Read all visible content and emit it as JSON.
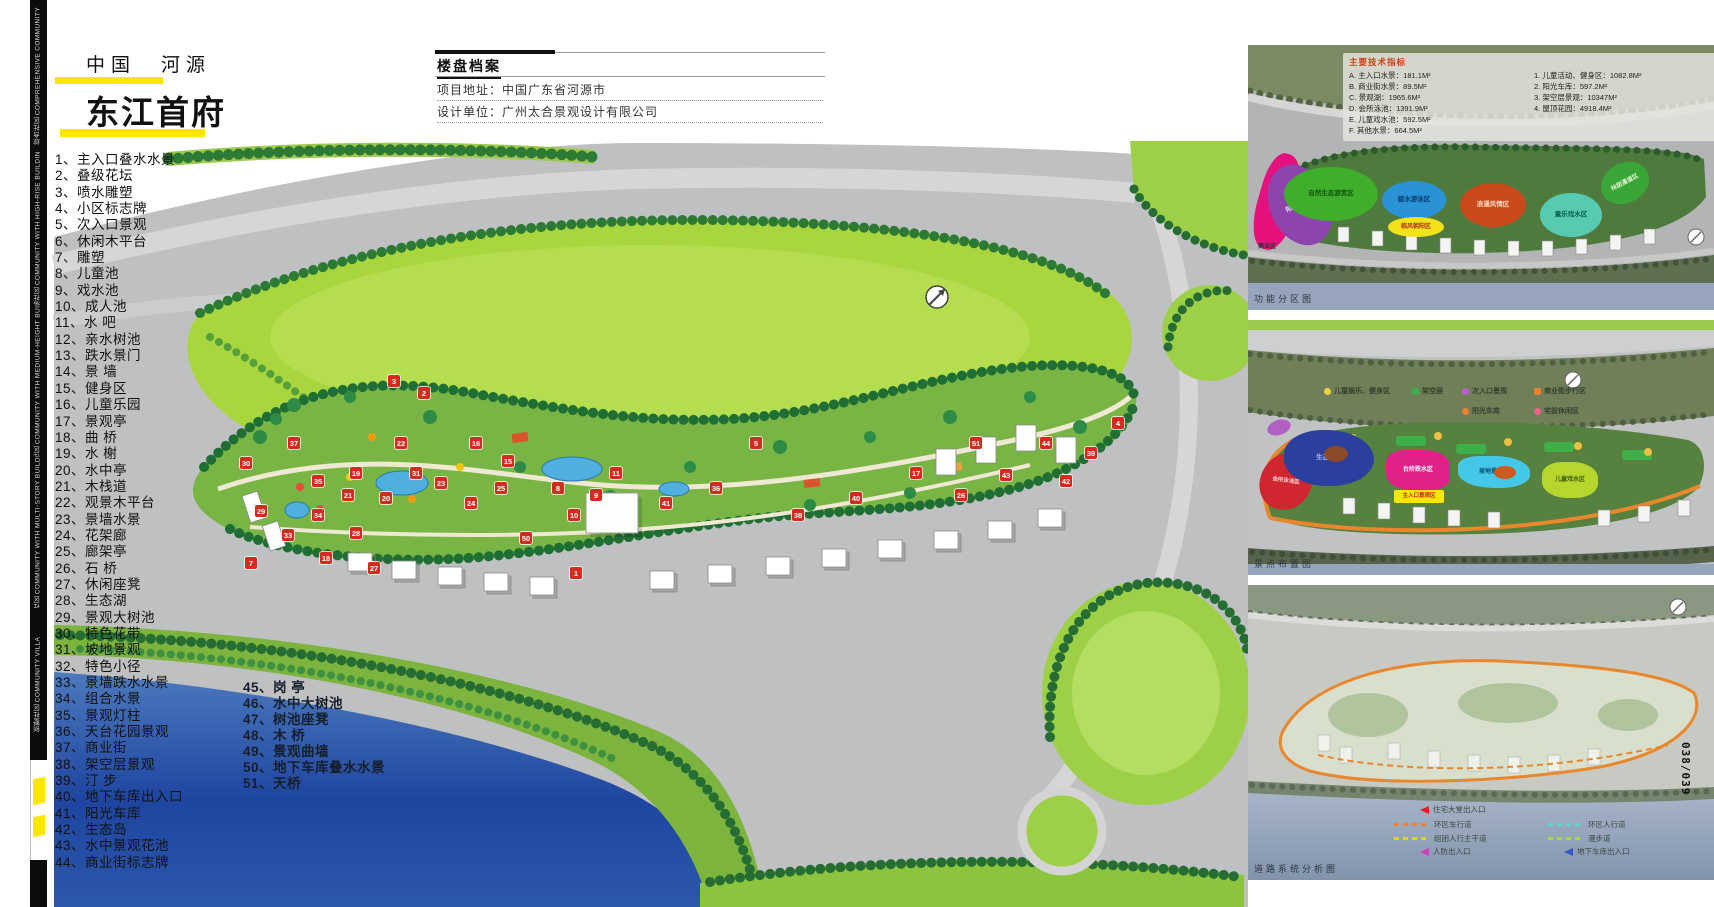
{
  "page": {
    "page_number": "038/039",
    "accent_color": "#ffe600"
  },
  "edge_strip": {
    "segments": [
      "综合社区 COMPREHENSIVE COMMUNITY",
      "高层社区 COMMUNITY WITH HIGH-RISE BUILDINGS",
      "小高层社区 COMMUNITY WITH MEDIUM-HEIGHT BUILDINGS",
      "多层社区 COMMUNITY WITH MULTI-STORY BUILDINGS",
      "别墅社区 COMMUNITY VILLA"
    ]
  },
  "header": {
    "location": "中国　河源",
    "project_name": "东江首府"
  },
  "property_file": {
    "title": "楼盘档案",
    "rows": [
      {
        "label": "项目地址：",
        "value": "中国广东省河源市"
      },
      {
        "label": "设计单位：",
        "value": "广州太合景观设计有限公司"
      }
    ]
  },
  "legend_col1": [
    "1、主入口叠水水景",
    "2、叠级花坛",
    "3、喷水雕塑",
    "4、小区标志牌",
    "5、次入口景观",
    "6、休闲木平台",
    "7、雕塑",
    "8、儿童池",
    "9、戏水池",
    "10、成人池",
    "11、水 吧",
    "12、亲水树池",
    "13、跌水景门",
    "14、景 墙",
    "15、健身区",
    "16、儿童乐园",
    "17、景观亭",
    "18、曲 桥",
    "19、水 榭",
    "20、水中亭",
    "21、木栈道",
    "22、观景木平台",
    "23、景墙水景",
    "24、花架廊",
    "25、廊架亭",
    "26、石 桥",
    "27、休闲座凳",
    "28、生态湖",
    "29、景观大树池",
    "30、特色花带",
    "31、坡地景观",
    "32、特色小径",
    "33、景墙跌水水景",
    "34、组合水景",
    "35、景观灯柱",
    "36、天台花园景观",
    "37、商业街",
    "38、架空层景观",
    "39、汀 步",
    "40、地下车库出入口",
    "41、阳光车库",
    "42、生态岛",
    "43、水中景观花池",
    "44、商业街标志牌"
  ],
  "legend_col2": [
    "45、岗 亭",
    "46、水中大树池",
    "47、树池座凳",
    "48、木 桥",
    "49、景观曲墙",
    "50、地下车库叠水水景",
    "51、天桥"
  ],
  "tech_indicators": {
    "title": "主要技术指标",
    "col_a": [
      "A. 主入口水景：181.1M²",
      "B. 商业街水景：89.5M²",
      "C. 景观湖：1965.6M²",
      "D. 会所泳池：1391.9M²",
      "E. 儿童戏水池：592.5M²",
      "F. 其他水景：664.5M²"
    ],
    "col_b": [
      "1. 儿童活动、健身区：1082.8M²",
      "2. 阳光车库：597.2M²",
      "3. 架空层景观：10347M²",
      "4. 屋顶花园：4918.4M²"
    ]
  },
  "minimap1": {
    "caption": "功能分区图",
    "zones": [
      {
        "label": "",
        "x": 10,
        "y": 108,
        "w": 40,
        "h": 98,
        "bg": "#e5127d",
        "rot": 16,
        "rad": "40% 60% 50% 50%"
      },
      {
        "label": "阳光静养区",
        "x": 22,
        "y": 118,
        "w": 60,
        "h": 84,
        "bg": "#8e44ad",
        "rot": -24,
        "tc": "#eadcf5",
        "fs": 6
      },
      {
        "label": "自然生态游赏区",
        "x": 36,
        "y": 122,
        "w": 94,
        "h": 54,
        "bg": "#3fae2a",
        "tc": "#15540e",
        "fs": 6.5
      },
      {
        "label": "碧水游泳区",
        "x": 134,
        "y": 136,
        "w": 64,
        "h": 38,
        "bg": "#2a93d5",
        "tc": "#083a6e",
        "fs": 6.5
      },
      {
        "label": "临风朝阳区",
        "x": 140,
        "y": 172,
        "w": 56,
        "h": 20,
        "bg": "#f3e11c",
        "tc": "#b03020",
        "fs": 6
      },
      {
        "label": "浪漫风情区",
        "x": 212,
        "y": 138,
        "w": 66,
        "h": 44,
        "bg": "#c8491a",
        "tc": "#ffd9c2",
        "fs": 6.5
      },
      {
        "label": "童乐戏水区",
        "x": 292,
        "y": 148,
        "w": 62,
        "h": 44,
        "bg": "#57cbb2",
        "tc": "#0a5c4a",
        "fs": 6.5
      },
      {
        "label": "林荫漫道区",
        "x": 352,
        "y": 118,
        "w": 50,
        "h": 40,
        "bg": "#39a637",
        "rot": -28,
        "tc": "#dff5c9",
        "fs": 6
      },
      {
        "label": "商业区",
        "x": 2,
        "y": 196,
        "w": 34,
        "h": 12,
        "bg": "transparent",
        "tc": "#2f2f2f",
        "fs": 6,
        "rad": "0"
      }
    ]
  },
  "minimap2": {
    "caption": "景点布置图",
    "zones": [
      {
        "label": "",
        "x": 19,
        "y": 100,
        "w": 24,
        "h": 15,
        "bg": "#b05fc4",
        "rot": -18
      },
      {
        "label": "会所泳池区",
        "x": 12,
        "y": 132,
        "w": 52,
        "h": 58,
        "bg": "#cf2630",
        "rot": 8,
        "tc": "#ffd7d7",
        "fs": 5.5,
        "rad": "60% 40% 55% 45%"
      },
      {
        "label": "生态湖区",
        "x": 36,
        "y": 110,
        "w": 90,
        "h": 56,
        "bg": "#2b3f9e",
        "tc": "#9db8f0",
        "fs": 6.5,
        "rad": "45% 55% 50% 50%"
      },
      {
        "label": "",
        "x": 76,
        "y": 126,
        "w": 24,
        "h": 16,
        "bg": "#8b4a2a"
      },
      {
        "label": "台阶跌水区",
        "x": 138,
        "y": 130,
        "w": 64,
        "h": 40,
        "bg": "#e0218a",
        "tc": "#ffffff",
        "fs": 6,
        "rad": "30% 40% 30% 40%"
      },
      {
        "label": "主入口景观区",
        "x": 146,
        "y": 170,
        "w": 50,
        "h": 13,
        "bg": "#ffe600",
        "tc": "#c02020",
        "fs": 5.5,
        "rad": "2px"
      },
      {
        "label": "坡地景观区",
        "x": 210,
        "y": 136,
        "w": 72,
        "h": 32,
        "bg": "#45c8e8",
        "tc": "#074f70",
        "fs": 6,
        "rad": "30% 50% 40% 50%"
      },
      {
        "label": "",
        "x": 246,
        "y": 146,
        "w": 22,
        "h": 13,
        "bg": "#cc5a1a"
      },
      {
        "label": "儿童戏水区",
        "x": 294,
        "y": 142,
        "w": 56,
        "h": 36,
        "bg": "#b6d62e",
        "tc": "#3f5e00",
        "fs": 6,
        "rad": "35% 45% 40% 45%"
      }
    ],
    "legend_dots": [
      {
        "x": 76,
        "y": 66,
        "color": "#f0d23c",
        "label": "儿童娱乐、健身区"
      },
      {
        "x": 214,
        "y": 66,
        "color": "#c05fd0",
        "label": "次入口景观"
      },
      {
        "x": 214,
        "y": 86,
        "color": "#f08030",
        "label": "阳光车库"
      },
      {
        "x": 286,
        "y": 86,
        "color": "#f06080",
        "label": "宅前休闲区"
      }
    ],
    "legend_squares": [
      {
        "x": 164,
        "y": 66,
        "color": "#3faf4a",
        "label": "架空层"
      },
      {
        "x": 286,
        "y": 66,
        "color": "#f08030",
        "label": "商业街步行区"
      }
    ]
  },
  "minimap3": {
    "caption": "道路系统分析图",
    "legend_arrows": [
      {
        "x": 168,
        "y": 219,
        "color": "#e02020",
        "label": "住宅大堂出入口"
      },
      {
        "x": 168,
        "y": 261,
        "color": "#d040c0",
        "label": "人防出入口"
      },
      {
        "x": 312,
        "y": 261,
        "color": "#3858c8",
        "label": "地下车库出入口"
      }
    ],
    "legend_dashes": [
      {
        "x": 146,
        "y": 234,
        "color": "#f08030",
        "label": "环区车行道"
      },
      {
        "x": 146,
        "y": 248,
        "color": "#e8d020",
        "label": "组团人行主干道"
      },
      {
        "x": 300,
        "y": 234,
        "color": "#58d8d0",
        "label": "环区人行道"
      },
      {
        "x": 300,
        "y": 248,
        "color": "#a8d840",
        "label": "漫步道"
      }
    ]
  },
  "main_plan": {
    "markers": [
      {
        "n": "30",
        "x": 190,
        "y": 320
      },
      {
        "n": "37",
        "x": 238,
        "y": 300
      },
      {
        "n": "35",
        "x": 262,
        "y": 338
      },
      {
        "n": "29",
        "x": 205,
        "y": 368
      },
      {
        "n": "33",
        "x": 232,
        "y": 392
      },
      {
        "n": "34",
        "x": 262,
        "y": 372
      },
      {
        "n": "21",
        "x": 292,
        "y": 352
      },
      {
        "n": "28",
        "x": 300,
        "y": 390
      },
      {
        "n": "7",
        "x": 195,
        "y": 420
      },
      {
        "n": "18",
        "x": 270,
        "y": 415
      },
      {
        "n": "27",
        "x": 318,
        "y": 425
      },
      {
        "n": "31",
        "x": 360,
        "y": 330
      },
      {
        "n": "19",
        "x": 300,
        "y": 330
      },
      {
        "n": "20",
        "x": 330,
        "y": 355
      },
      {
        "n": "22",
        "x": 345,
        "y": 300
      },
      {
        "n": "23",
        "x": 385,
        "y": 340
      },
      {
        "n": "24",
        "x": 415,
        "y": 360
      },
      {
        "n": "25",
        "x": 445,
        "y": 345
      },
      {
        "n": "3",
        "x": 338,
        "y": 238
      },
      {
        "n": "2",
        "x": 368,
        "y": 250
      },
      {
        "n": "16",
        "x": 420,
        "y": 300
      },
      {
        "n": "15",
        "x": 452,
        "y": 318
      },
      {
        "n": "8",
        "x": 502,
        "y": 345
      },
      {
        "n": "9",
        "x": 540,
        "y": 352
      },
      {
        "n": "10",
        "x": 518,
        "y": 372
      },
      {
        "n": "11",
        "x": 560,
        "y": 330
      },
      {
        "n": "1",
        "x": 520,
        "y": 430
      },
      {
        "n": "50",
        "x": 470,
        "y": 395
      },
      {
        "n": "41",
        "x": 610,
        "y": 360
      },
      {
        "n": "36",
        "x": 660,
        "y": 345
      },
      {
        "n": "5",
        "x": 700,
        "y": 300
      },
      {
        "n": "38",
        "x": 742,
        "y": 372
      },
      {
        "n": "40",
        "x": 800,
        "y": 355
      },
      {
        "n": "17",
        "x": 860,
        "y": 330
      },
      {
        "n": "51",
        "x": 920,
        "y": 300
      },
      {
        "n": "26",
        "x": 905,
        "y": 352
      },
      {
        "n": "43",
        "x": 950,
        "y": 332
      },
      {
        "n": "44",
        "x": 990,
        "y": 300
      },
      {
        "n": "42",
        "x": 1010,
        "y": 338
      },
      {
        "n": "39",
        "x": 1035,
        "y": 310
      },
      {
        "n": "4",
        "x": 1062,
        "y": 280
      }
    ]
  }
}
